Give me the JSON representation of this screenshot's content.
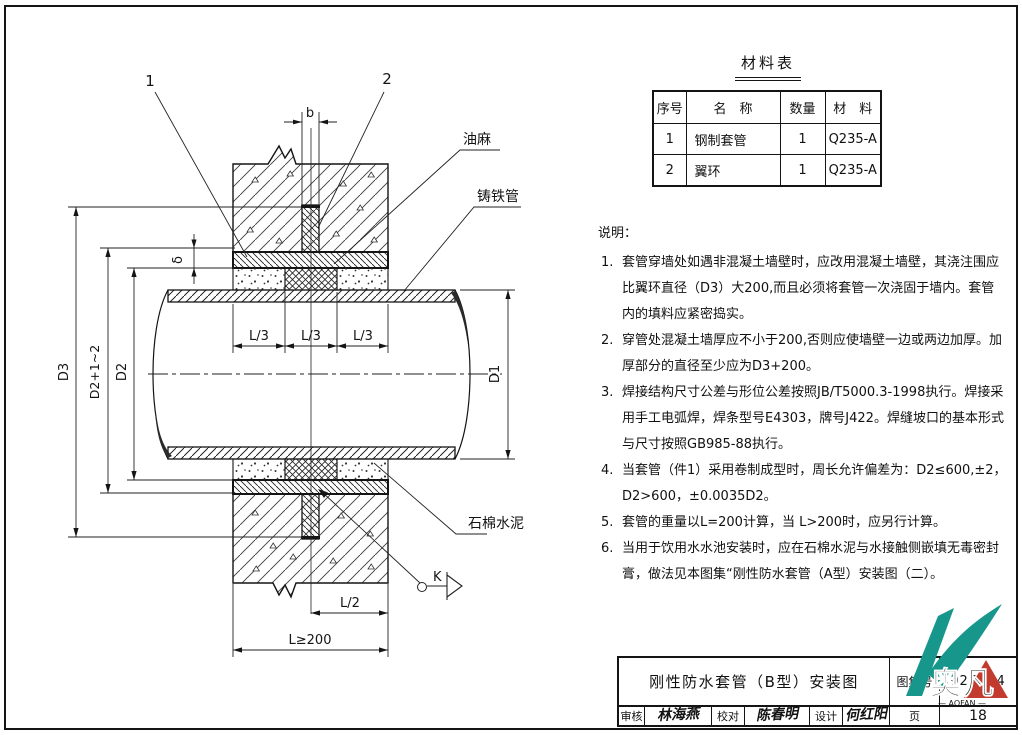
{
  "drawing": {
    "callouts": {
      "c1": "1",
      "c2": "2"
    },
    "dims": {
      "b": "b",
      "delta": "δ",
      "d3": "D3",
      "d2plus": "D2+1~2",
      "d2": "D2",
      "d1": "D1",
      "l3": "L/3",
      "l2": "L/2",
      "l200": "L≥200"
    },
    "labels": {
      "oakum": "油麻",
      "cast_iron_pipe": "铸铁管",
      "asbestos_cement": "石棉水泥",
      "detail_k": "K"
    }
  },
  "materials_table": {
    "title": "材料表",
    "headers": [
      "序号",
      "名　称",
      "数量",
      "材　料"
    ],
    "rows": [
      [
        "1",
        "钢制套管",
        "1",
        "Q235-A"
      ],
      [
        "2",
        "翼环",
        "1",
        "Q235-A"
      ]
    ]
  },
  "notes": {
    "title": "说明：",
    "items": [
      {
        "num": "1.",
        "text": "套管穿墙处如遇非混凝土墙壁时，应改用混凝土墙壁，其浇注围应比翼环直径（D3）大200,而且必须将套管一次浇固于墙内。套管内的填料应紧密捣实。"
      },
      {
        "num": "2.",
        "text": "穿管处混凝土墙厚应不小于200,否则应使墙壁一边或两边加厚。加厚部分的直径至少应为D3+200。"
      },
      {
        "num": "3.",
        "text": "焊接结构尺寸公差与形位公差按照JB/T5000.3-1998执行。焊接采用手工电弧焊，焊条型号E4303，牌号J422。焊缝坡口的基本形式与尺寸按照GB985-88执行。"
      },
      {
        "num": "4.",
        "text": "当套管（件1）采用卷制成型时，周长允许偏差为：D2≤600,±2，D2>600，±0.0035D2。"
      },
      {
        "num": "5.",
        "text": "套管的重量以L=200计算，当 L>200时，应另行计算。"
      },
      {
        "num": "6.",
        "text": "当用于饮用水水池安装时，应在石棉水泥与水接触侧嵌填无毒密封膏，做法见本图集“刚性防水套管（A型）安装图（二）。"
      }
    ]
  },
  "title_block": {
    "title": "刚性防水套管（B型）安装图",
    "atlas_label": "图集号",
    "atlas_number": "02S404",
    "page_label": "页",
    "page_number": "18",
    "reviewer_label": "审核",
    "reviewer_name": "林海燕",
    "proof_label": "校对",
    "proof_name": "陈春明",
    "design_label": "设计",
    "design_name": "何红阳"
  },
  "logo": {
    "chars": "奥凡",
    "sub": "— AOFAN —",
    "teal": "#17978c",
    "blue": "#1d5fae",
    "red": "#c23b2e"
  }
}
